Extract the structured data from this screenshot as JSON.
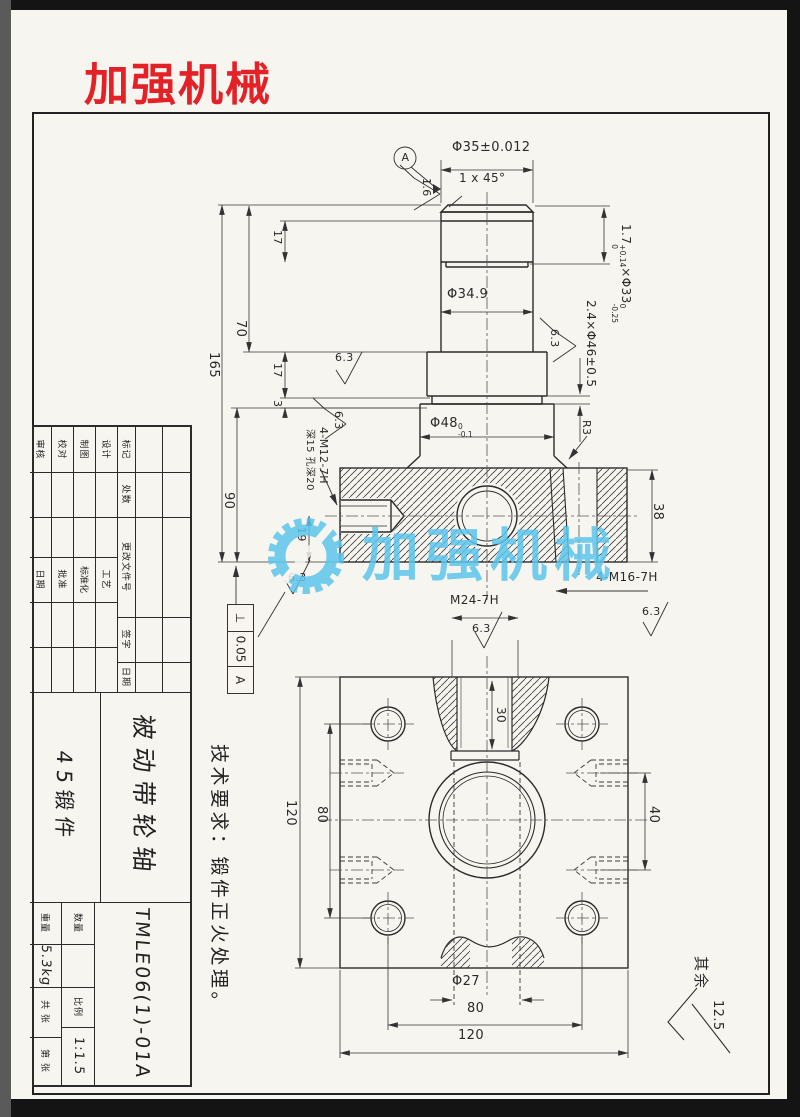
{
  "brand": {
    "logo": "加强机械",
    "watermark": "加强机械"
  },
  "notes": {
    "tech_req": "技术要求：锻件正火处理。",
    "other_label": "其余",
    "other_value": "12.5"
  },
  "shaft": {
    "datum": "A",
    "rough16": "1.6",
    "rough63": "6.3",
    "dim_phi35": "Φ35±0.012",
    "chamfer": "1 x 45°",
    "g33_a": "1.7",
    "g33_au": "+0.14",
    "g33_ad": "0",
    "g33_b": "×Φ33",
    "g33_bu": "0",
    "g33_bd": "-0.25",
    "g46": "2.4×Φ46±0.5",
    "phi349": "Φ34.9",
    "phi48": "Φ48",
    "phi48_u": "0",
    "phi48_d": "-0.1",
    "r3": "R3",
    "d165": "165",
    "d70": "70",
    "d17": "17",
    "d3": "3",
    "d90": "90",
    "d19": "19",
    "d38": "38",
    "m12": "4-M12-7H",
    "m12_depth": "深15 孔深20",
    "m16": "4-M16-7H",
    "m24": "M24-7H",
    "tol_sym": "⊥",
    "tol_val": "0.05",
    "tol_datum": "A"
  },
  "plate": {
    "d120": "120",
    "d80": "80",
    "d40": "40",
    "d30": "30",
    "phi27": "Φ27"
  },
  "title_block": {
    "rev_headers": [
      "标记",
      "处数",
      "更改文件号",
      "签字",
      "日期"
    ],
    "roles_left": [
      "设计",
      "制图",
      "校对",
      "审核"
    ],
    "roles_right": [
      "工艺",
      "标准化",
      "批准",
      "日期"
    ],
    "part_name": "被动带轮轴",
    "material": "45锻件",
    "drawing_no": "TMLE06(1)-01A",
    "qty_label": "数量",
    "scale_label": "比例",
    "scale_value": "1:1.5",
    "weight_label": "重量",
    "weight_value": "5.3kg",
    "sheet_total": "共 张",
    "sheet_no": "第 张"
  }
}
